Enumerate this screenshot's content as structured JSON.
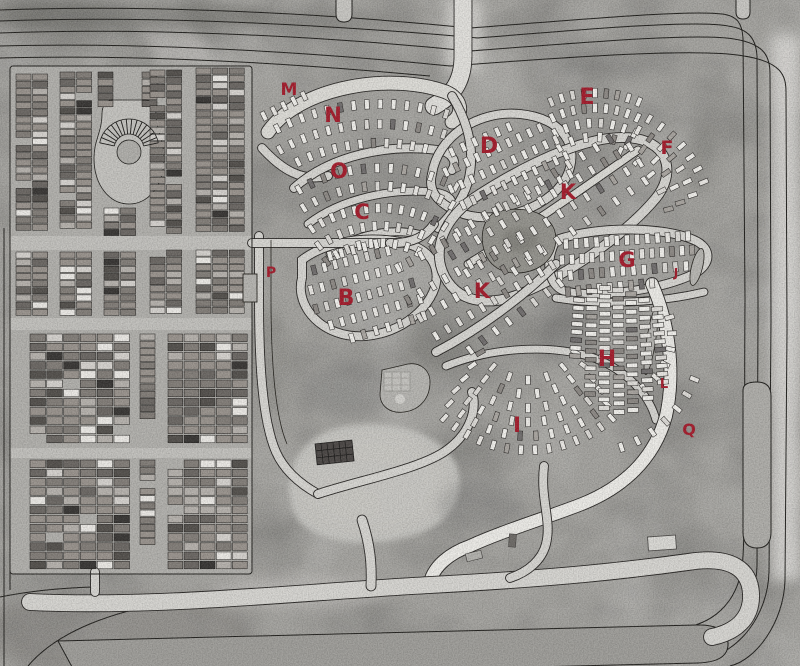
{
  "map": {
    "type": "aerial-map",
    "label_color": "#a51d2d",
    "sections": [
      {
        "id": "M",
        "label": "M",
        "x": 289,
        "y": 95,
        "size": 17
      },
      {
        "id": "N",
        "label": "N",
        "x": 333,
        "y": 122,
        "size": 21
      },
      {
        "id": "O",
        "label": "O",
        "x": 339,
        "y": 178,
        "size": 21
      },
      {
        "id": "C",
        "label": "C",
        "x": 362,
        "y": 219,
        "size": 21
      },
      {
        "id": "P",
        "label": "P",
        "x": 271,
        "y": 277,
        "size": 14
      },
      {
        "id": "B",
        "label": "B",
        "x": 346,
        "y": 305,
        "size": 22
      },
      {
        "id": "D",
        "label": "D",
        "x": 489,
        "y": 153,
        "size": 22
      },
      {
        "id": "E",
        "label": "E",
        "x": 587,
        "y": 104,
        "size": 22
      },
      {
        "id": "F",
        "label": "F",
        "x": 667,
        "y": 154,
        "size": 19
      },
      {
        "id": "K-upper",
        "label": "K",
        "x": 568,
        "y": 199,
        "size": 21
      },
      {
        "id": "K-lower",
        "label": "K",
        "x": 482,
        "y": 298,
        "size": 21
      },
      {
        "id": "G",
        "label": "G",
        "x": 627,
        "y": 267,
        "size": 21
      },
      {
        "id": "J",
        "label": "J",
        "x": 676,
        "y": 277,
        "size": 12
      },
      {
        "id": "H",
        "label": "H",
        "x": 607,
        "y": 366,
        "size": 22
      },
      {
        "id": "L",
        "label": "L",
        "x": 664,
        "y": 388,
        "size": 13
      },
      {
        "id": "Q",
        "label": "Q",
        "x": 689,
        "y": 435,
        "size": 16
      },
      {
        "id": "I",
        "label": "I",
        "x": 517,
        "y": 432,
        "size": 21
      }
    ]
  }
}
